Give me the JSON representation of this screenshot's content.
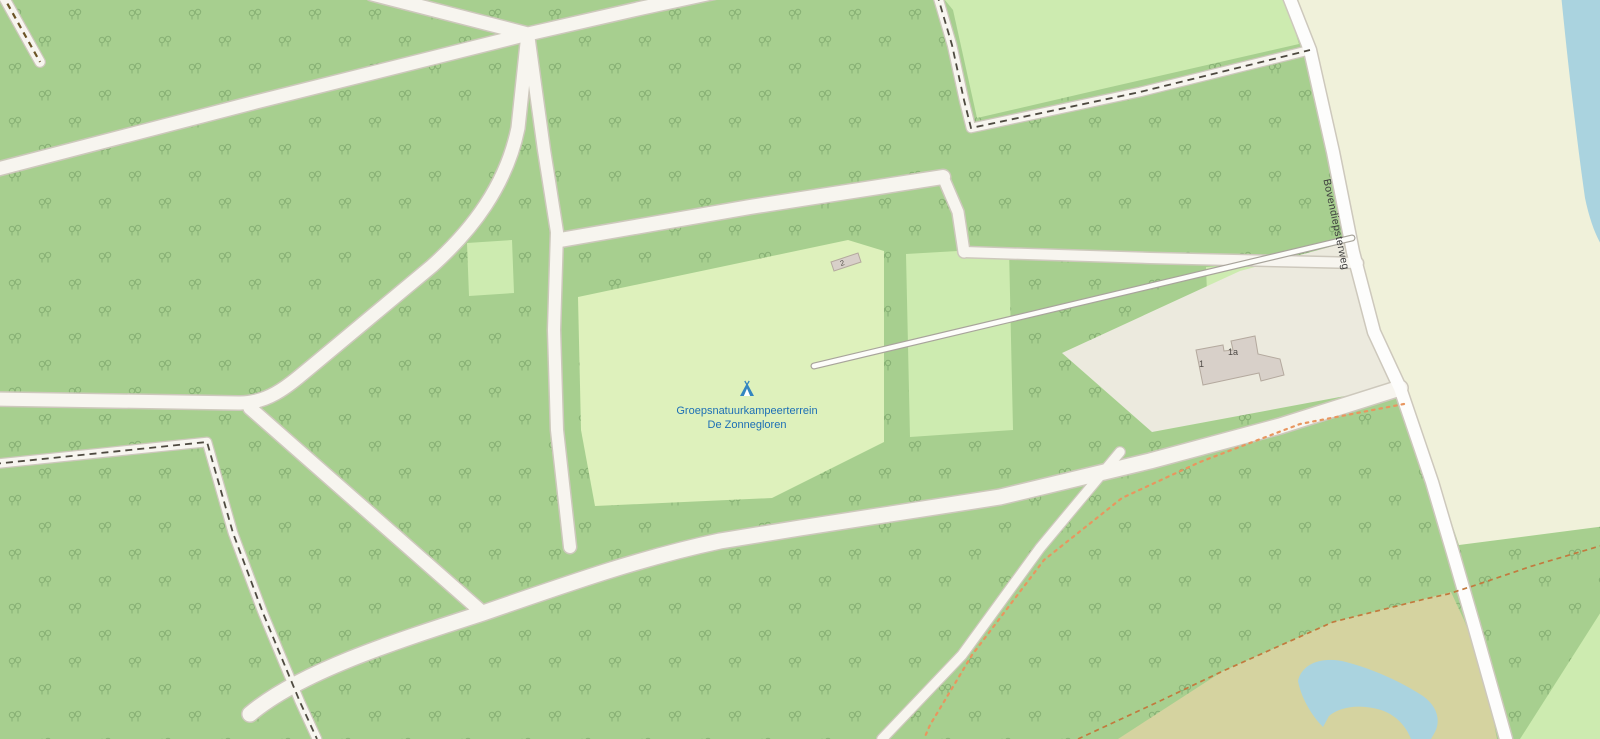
{
  "labels": {
    "campsite_line1": "Groepsnatuurkampeerterrein",
    "campsite_line2": "De Zonnegloren",
    "street": "Bovendiepsterweg",
    "house_1": "1",
    "house_1a": "1a",
    "house_2": "2"
  },
  "icons": {
    "campsite": "tent-icon"
  },
  "palette": {
    "forest": "#a7cf8f",
    "tree": "#7ea86c",
    "grass": "#cdebb0",
    "campsite": "#def1bc",
    "farmland": "#f0f1da",
    "heath": "#d5d3a0",
    "water": "#aad3df",
    "road_fill": "#f7f5ef",
    "road_casing": "#cdc8bc",
    "b_road_fill": "#fdfdfc",
    "driveway_fill": "#fdfdfa",
    "driveway_casing": "#a8a49b",
    "track_dash_dark": "#4e4a40",
    "track_dash_brown": "#6b5426",
    "path_dot": "#e8965f",
    "path_dash": "#c27a3e",
    "building_fill": "#d8d0c9",
    "building_stroke": "#b4a99e",
    "label_blue": "#1d6fb5",
    "label_dark": "#4e4a45",
    "street_label": "#3c3c3c"
  }
}
